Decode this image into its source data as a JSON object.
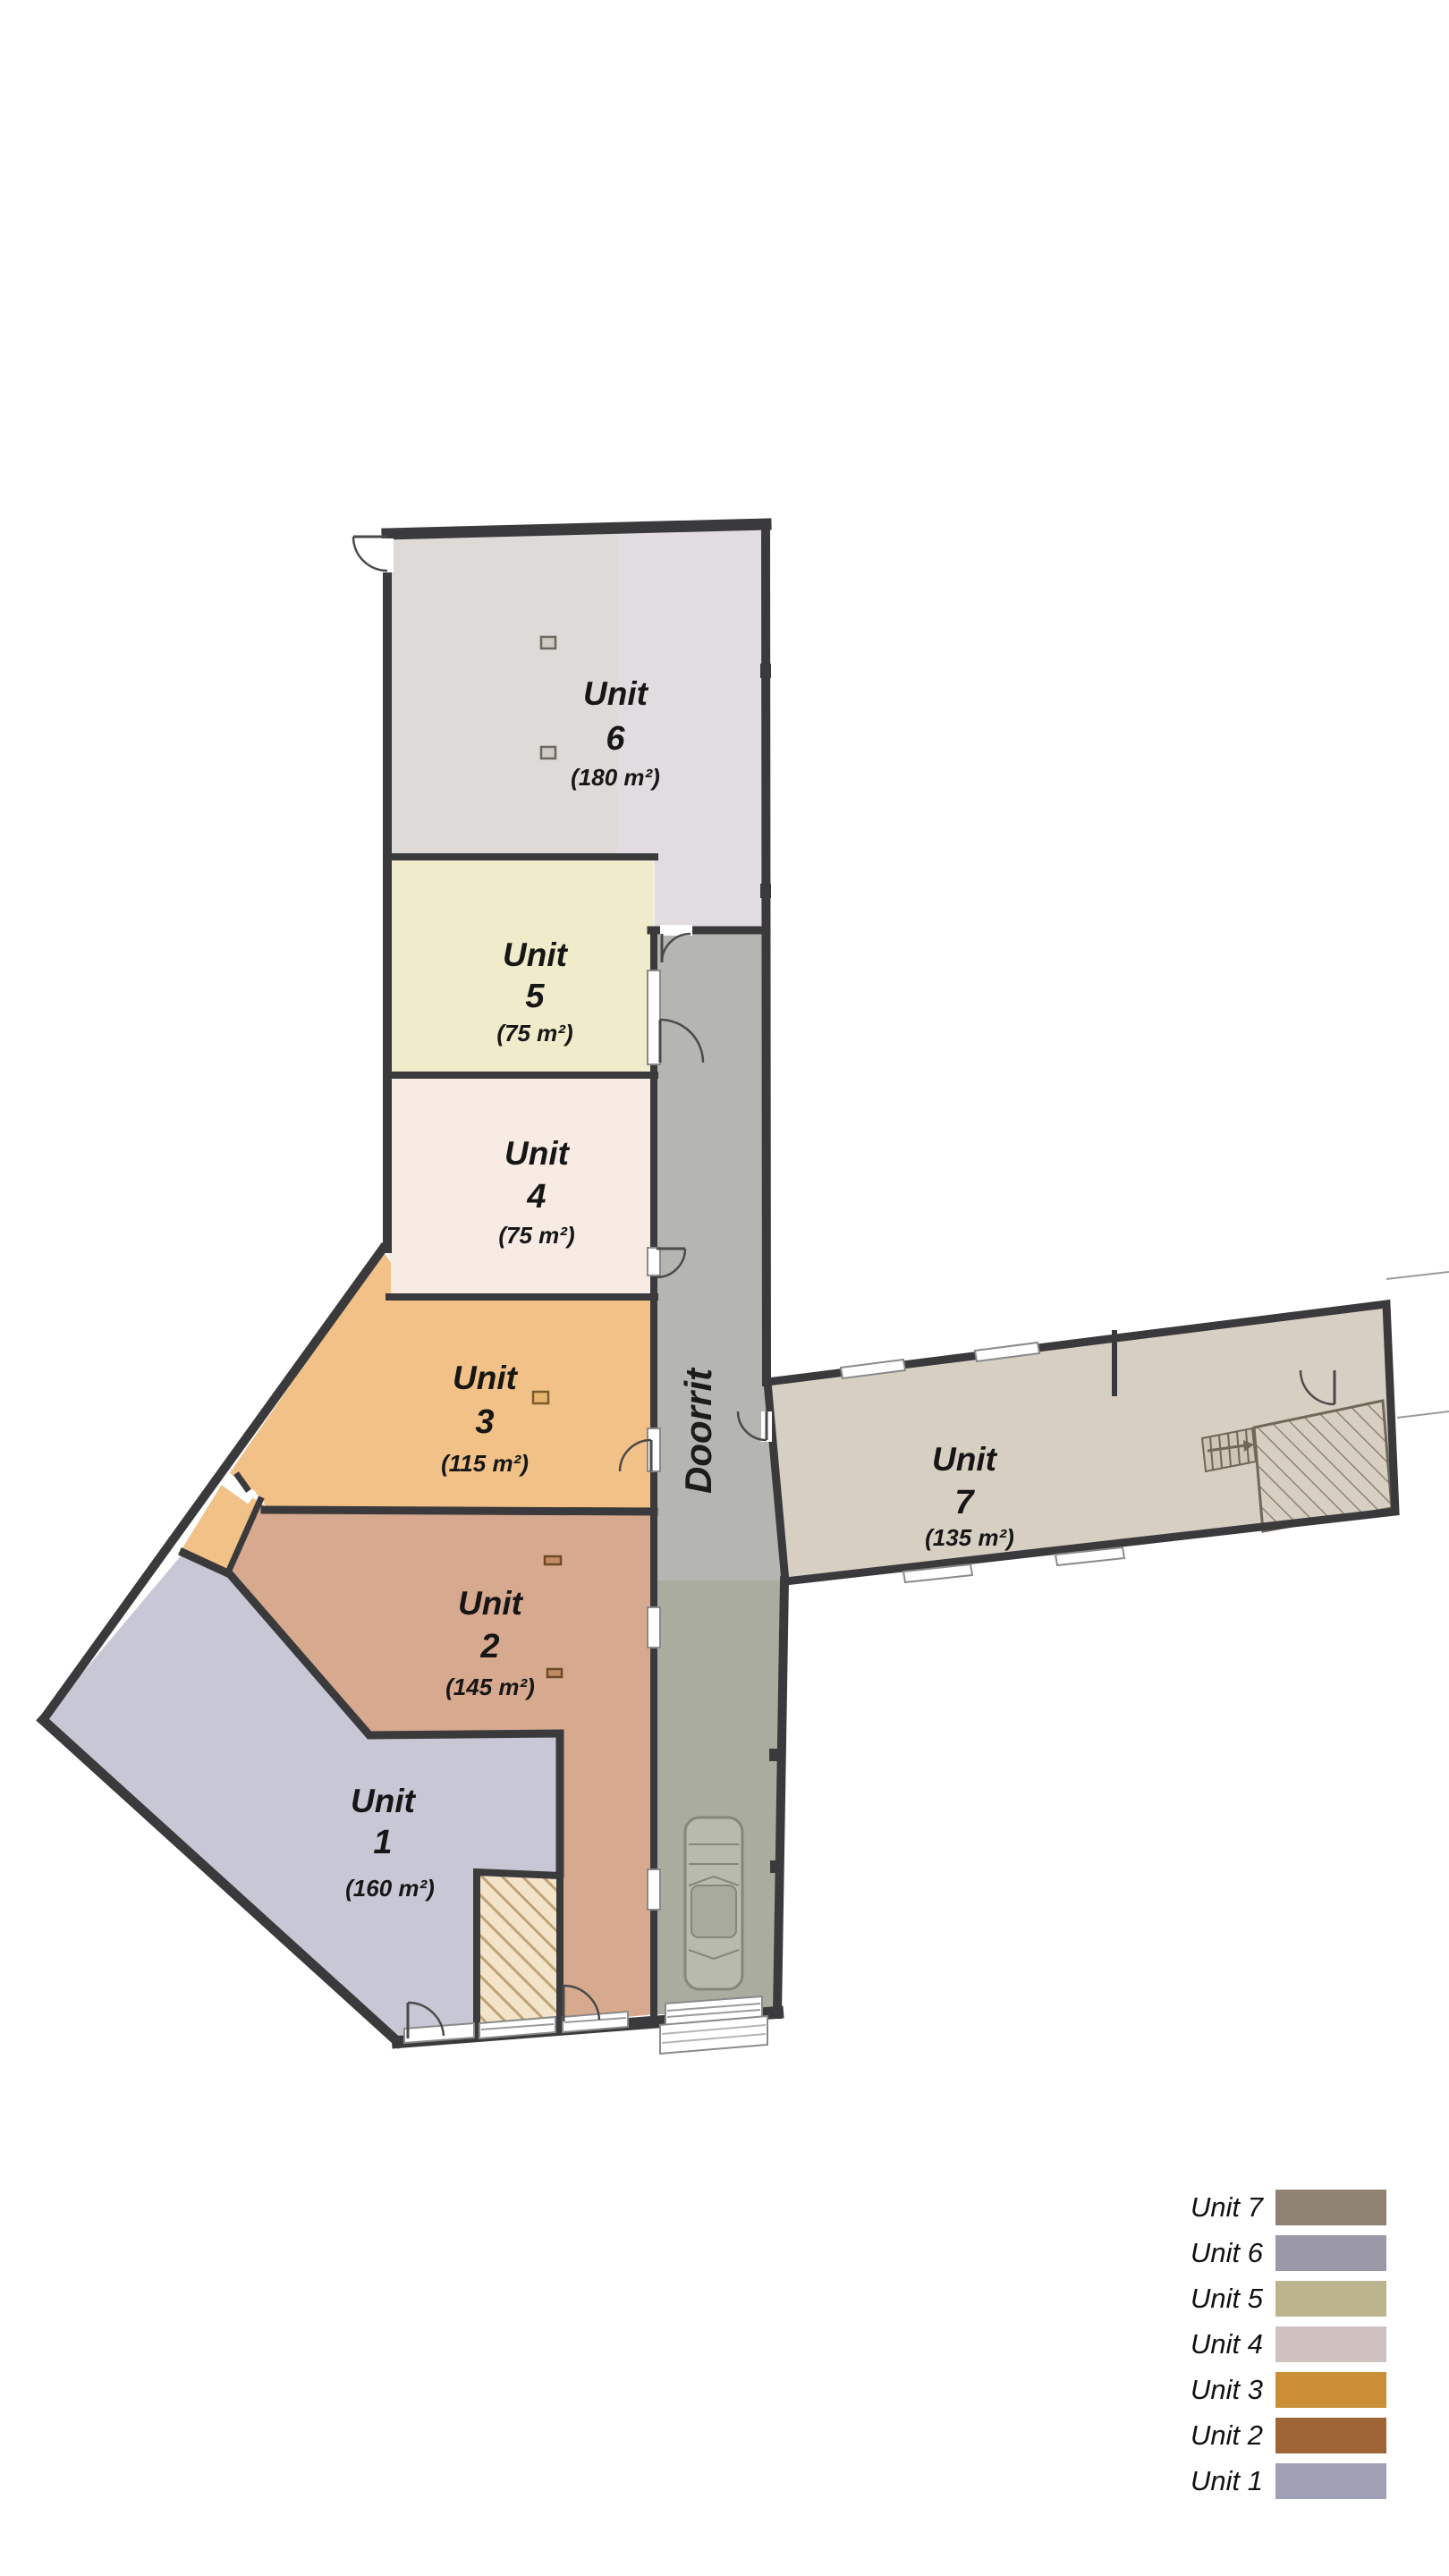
{
  "plan": {
    "units": {
      "u1": {
        "label": "Unit",
        "number": "1",
        "area": "(160 m²)",
        "fill": "#c8c7d6"
      },
      "u2": {
        "label": "Unit",
        "number": "2",
        "area": "(145 m²)",
        "fill": "#d7a98e"
      },
      "u3": {
        "label": "Unit",
        "number": "3",
        "area": "(115 m²)",
        "fill": "#f1c187"
      },
      "u4": {
        "label": "Unit",
        "number": "4",
        "area": "(75 m²)",
        "fill": "#f8ebe4"
      },
      "u5": {
        "label": "Unit",
        "number": "5",
        "area": "(75 m²)",
        "fill": "#f0ebcb"
      },
      "u6": {
        "label": "Unit",
        "number": "6",
        "area": "(180 m²)",
        "fill": "#dedad8"
      },
      "u7": {
        "label": "Unit",
        "number": "7",
        "area": "(135 m²)",
        "fill": "#d8cfc3"
      }
    },
    "corridor": {
      "label": "Doorrit",
      "fill_upper": "#b5b5b2",
      "fill_lower": "#a9ac9f"
    }
  },
  "legend": {
    "rows": [
      {
        "label": "Unit 7",
        "color": "#8f8270"
      },
      {
        "label": "Unit 6",
        "color": "#9b99a8"
      },
      {
        "label": "Unit 5",
        "color": "#bcb48d"
      },
      {
        "label": "Unit 4",
        "color": "#d0c1c1"
      },
      {
        "label": "Unit 3",
        "color": "#c98e36"
      },
      {
        "label": "Unit 2",
        "color": "#a06537"
      },
      {
        "label": "Unit 1",
        "color": "#a0a0b4"
      }
    ]
  }
}
